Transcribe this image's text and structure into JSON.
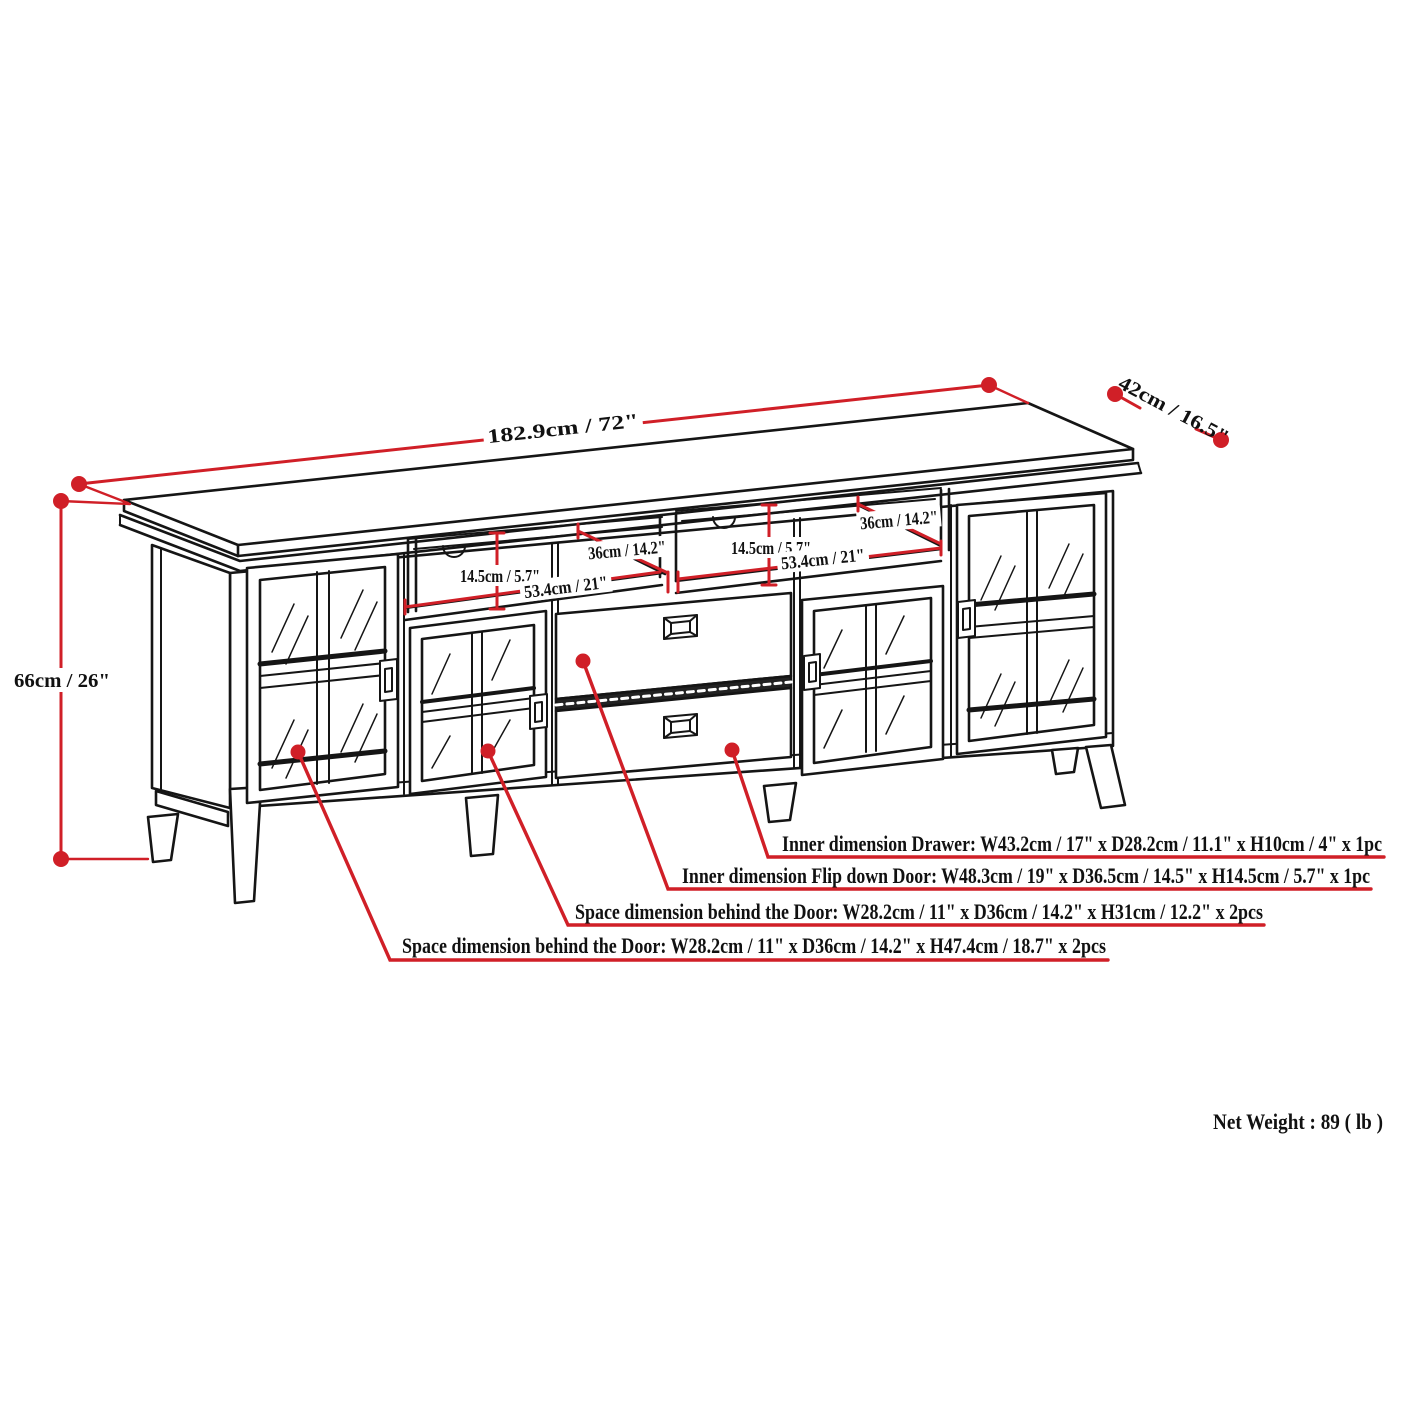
{
  "dimensions": {
    "width": "182.9cm / 72\"",
    "depth": "42cm / 16.5\"",
    "height": "66cm / 26\"",
    "left_shelf": {
      "height": "14.5cm / 5.7\"",
      "width": "53.4cm / 21\"",
      "depth": "36cm / 14.2\""
    },
    "right_shelf": {
      "height": "14.5cm / 5.7\"",
      "width": "53.4cm / 21\"",
      "depth": "36cm / 14.2\""
    }
  },
  "annotations": [
    {
      "label": "Inner dimension Drawer: W43.2cm / 17\" x D28.2cm / 11.1\" x H10cm / 4\" x 1pc"
    },
    {
      "label": "Inner dimension Flip down Door: W48.3cm / 19\" x D36.5cm / 14.5\" x H14.5cm / 5.7\" x 1pc"
    },
    {
      "label": "Space dimension behind the Door: W28.2cm / 11\" x D36cm / 14.2\" x H31cm / 12.2\" x 2pcs"
    },
    {
      "label": "Space dimension behind the Door:  W28.2cm / 11\" x D36cm / 14.2\" x H47.4cm / 18.7\" x 2pcs"
    }
  ],
  "footer": {
    "net_weight": "Net Weight : 89 ( lb )"
  },
  "colors": {
    "dimension_red": "#d01f27",
    "line_black": "#151515"
  }
}
